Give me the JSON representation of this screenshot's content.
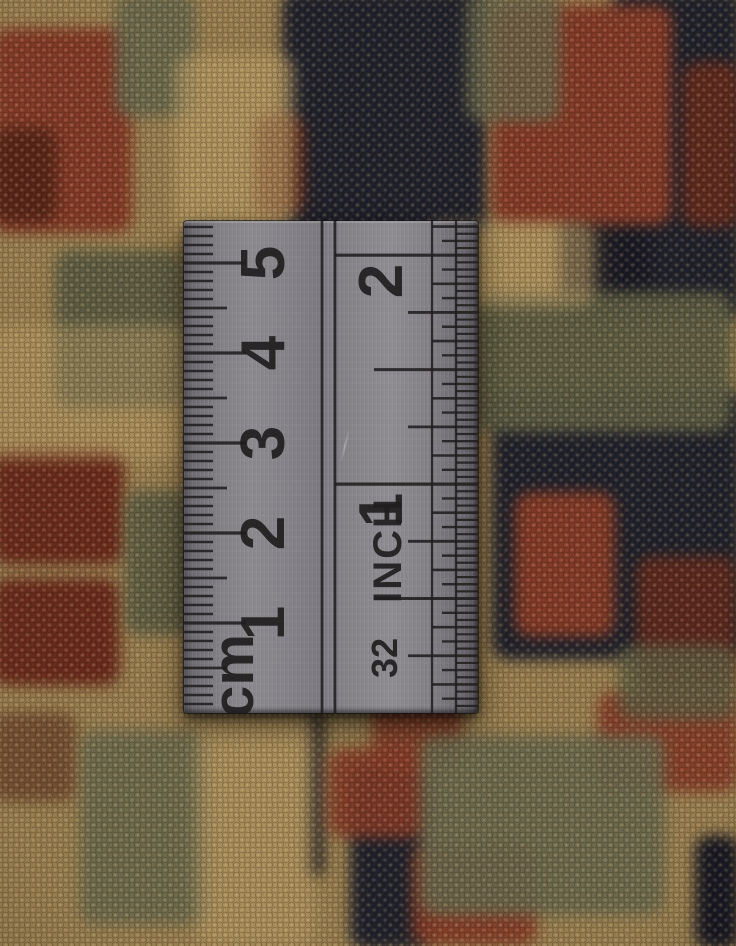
{
  "ruler": {
    "cm_scale": {
      "unit_label": "cm",
      "numerals": [
        "1",
        "2",
        "3",
        "4",
        "5"
      ]
    },
    "inch_scale": {
      "unit_label": "INCH",
      "numerals": [
        "1",
        "2"
      ],
      "fraction_label": "32"
    },
    "colors": {
      "metal": "#86848a",
      "metal_edge": "#555358",
      "markings": "#211e1f"
    }
  },
  "rug": {
    "palette": {
      "tan": "#b0915c",
      "tanLight": "#c9ab70",
      "rust": "#8a3a28",
      "rustDark": "#6e2a1c",
      "maroon": "#522016",
      "navy": "#1b1f2e",
      "navyDeep": "#131625",
      "green": "#5d6047",
      "greenGray": "#6b6d52"
    },
    "motifs": [
      {
        "x": 282,
        "y": -10,
        "w": 205,
        "h": 250,
        "c": "navy",
        "o": 1
      },
      {
        "x": 612,
        "y": -10,
        "w": 130,
        "h": 330,
        "c": "navy",
        "o": 1
      },
      {
        "x": 560,
        "y": 170,
        "w": 90,
        "h": 150,
        "c": "navyDeep",
        "o": 0.9
      },
      {
        "x": 492,
        "y": 390,
        "w": 250,
        "h": 270,
        "c": "navy",
        "o": 1
      },
      {
        "x": 350,
        "y": 765,
        "w": 80,
        "h": 185,
        "c": "navy",
        "o": 1
      },
      {
        "x": 695,
        "y": 835,
        "w": 45,
        "h": 115,
        "c": "navyDeep",
        "o": 1
      },
      {
        "x": 308,
        "y": 712,
        "w": 16,
        "h": 165,
        "c": "navyDeep",
        "o": 0.85
      },
      {
        "x": -8,
        "y": 28,
        "w": 140,
        "h": 205,
        "c": "rust",
        "o": 1
      },
      {
        "x": -8,
        "y": 128,
        "w": 65,
        "h": 95,
        "c": "maroon",
        "o": 0.85
      },
      {
        "x": 492,
        "y": 5,
        "w": 180,
        "h": 220,
        "c": "rust",
        "o": 1
      },
      {
        "x": 255,
        "y": 115,
        "w": 50,
        "h": 100,
        "c": "rustDark",
        "o": 0.8
      },
      {
        "x": 682,
        "y": 62,
        "w": 58,
        "h": 165,
        "c": "rustDark",
        "o": 0.85
      },
      {
        "x": -8,
        "y": 450,
        "w": 132,
        "h": 115,
        "c": "rustDark",
        "o": 1
      },
      {
        "x": -8,
        "y": 578,
        "w": 128,
        "h": 108,
        "c": "rustDark",
        "o": 1
      },
      {
        "x": 515,
        "y": 492,
        "w": 100,
        "h": 145,
        "c": "rust",
        "o": 1
      },
      {
        "x": 328,
        "y": 748,
        "w": 105,
        "h": 90,
        "c": "rust",
        "o": 0.9
      },
      {
        "x": 372,
        "y": 695,
        "w": 90,
        "h": 75,
        "c": "rust",
        "o": 0.85
      },
      {
        "x": 598,
        "y": 692,
        "w": 140,
        "h": 100,
        "c": "rust",
        "o": 0.9
      },
      {
        "x": 412,
        "y": 845,
        "w": 125,
        "h": 101,
        "c": "rust",
        "o": 0.9
      },
      {
        "x": 636,
        "y": 556,
        "w": 100,
        "h": 135,
        "c": "rustDark",
        "o": 0.8
      },
      {
        "x": -8,
        "y": 712,
        "w": 85,
        "h": 90,
        "c": "maroon",
        "o": 0.5
      },
      {
        "x": 115,
        "y": -8,
        "w": 80,
        "h": 125,
        "c": "greenGray",
        "o": 0.9
      },
      {
        "x": 55,
        "y": 250,
        "w": 128,
        "h": 158,
        "c": "green",
        "o": 0.95
      },
      {
        "x": 125,
        "y": 490,
        "w": 65,
        "h": 145,
        "c": "green",
        "o": 0.9
      },
      {
        "x": 476,
        "y": 292,
        "w": 256,
        "h": 140,
        "c": "green",
        "o": 0.95
      },
      {
        "x": 466,
        "y": -8,
        "w": 95,
        "h": 130,
        "c": "greenGray",
        "o": 0.8
      },
      {
        "x": 80,
        "y": 730,
        "w": 128,
        "h": 195,
        "c": "greenGray",
        "o": 0.85
      },
      {
        "x": 420,
        "y": 735,
        "w": 245,
        "h": 180,
        "c": "greenGray",
        "o": 0.9
      },
      {
        "x": 618,
        "y": 645,
        "w": 118,
        "h": 75,
        "c": "green",
        "o": 0.8
      },
      {
        "x": 175,
        "y": 55,
        "w": 120,
        "h": 185,
        "c": "tanLight",
        "o": 0.6
      },
      {
        "x": 425,
        "y": 222,
        "w": 170,
        "h": 85,
        "c": "tanLight",
        "o": 0.55
      },
      {
        "x": 196,
        "y": 714,
        "w": 118,
        "h": 232,
        "c": "tanLight",
        "o": 0.5
      },
      {
        "x": -8,
        "y": 325,
        "w": 200,
        "h": 135,
        "c": "tanLight",
        "o": 0.45
      }
    ]
  }
}
